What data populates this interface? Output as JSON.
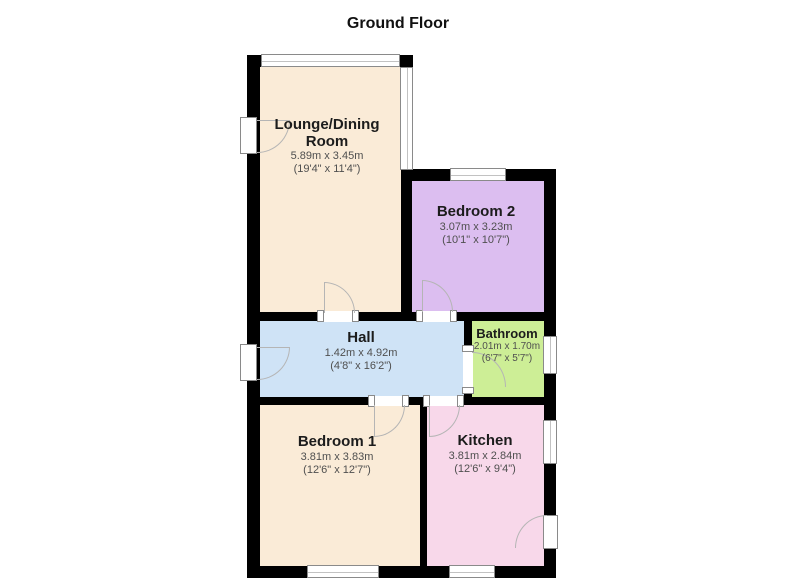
{
  "title": "Ground Floor",
  "colors": {
    "wall": "#000000",
    "window_border": "#8a8a8a",
    "door_arc": "#b5b5b5",
    "room_cream": "#faebd7",
    "room_purple": "#dcbef0",
    "room_blue": "#cfe3f6",
    "room_green": "#cdee96",
    "room_pink": "#f8d8ea",
    "text_primary": "#1c1c1c",
    "text_secondary": "#4f4f4f"
  },
  "rooms": {
    "lounge": {
      "name_line1": "Lounge/Dining",
      "name_line2": "Room",
      "metric": "5.89m x 3.45m",
      "imperial": "(19'4\" x 11'4\")",
      "color": "#faebd7"
    },
    "bedroom2": {
      "name": "Bedroom 2",
      "metric": "3.07m x 3.23m",
      "imperial": "(10'1\" x 10'7\")",
      "color": "#dcbef0"
    },
    "hall": {
      "name": "Hall",
      "metric": "1.42m x 4.92m",
      "imperial": "(4'8\" x 16'2\")",
      "color": "#cfe3f6"
    },
    "bathroom": {
      "name": "Bathroom",
      "metric": "2.01m x 1.70m",
      "imperial": "(6'7\" x 5'7\")",
      "color": "#cdee96"
    },
    "bedroom1": {
      "name": "Bedroom 1",
      "metric": "3.81m x 3.83m",
      "imperial": "(12'6\" x 12'7\")",
      "color": "#faebd7"
    },
    "kitchen": {
      "name": "Kitchen",
      "metric": "3.81m x 2.84m",
      "imperial": "(12'6\" x 9'4\")",
      "color": "#f8d8ea"
    }
  }
}
